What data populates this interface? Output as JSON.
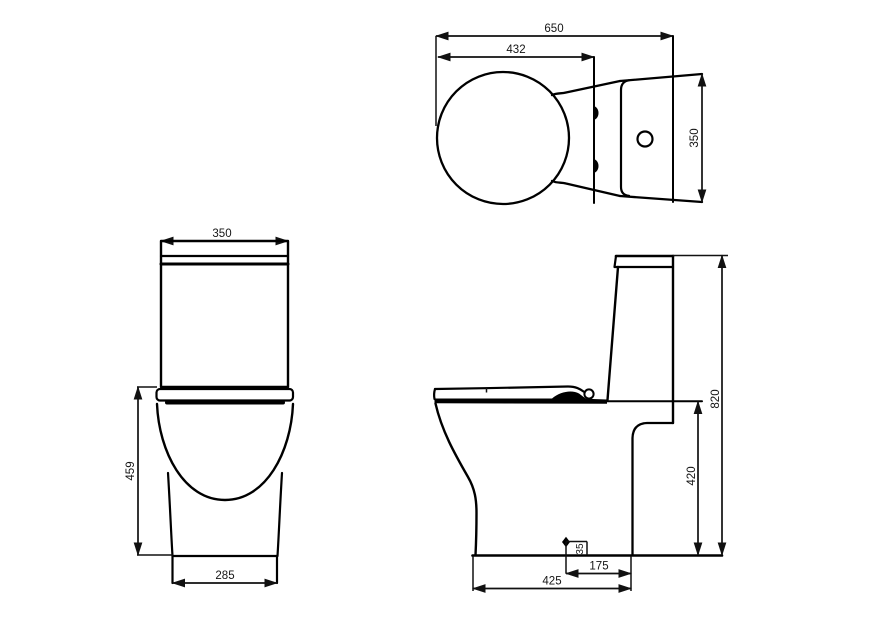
{
  "drawing": {
    "views": {
      "top": {
        "name": "plan view"
      },
      "front": {
        "name": "front view"
      },
      "side": {
        "name": "side view"
      }
    }
  },
  "dimensions": {
    "top_view": {
      "overall_depth": "650",
      "seat_depth": "432",
      "width": "350"
    },
    "front_view": {
      "tank_width": "350",
      "seat_height": "459",
      "base_width": "285"
    },
    "side_view": {
      "overall_height": "820",
      "bowl_height": "420",
      "base_depth": "425",
      "outlet_setout": "175",
      "outlet_height": "35"
    }
  }
}
